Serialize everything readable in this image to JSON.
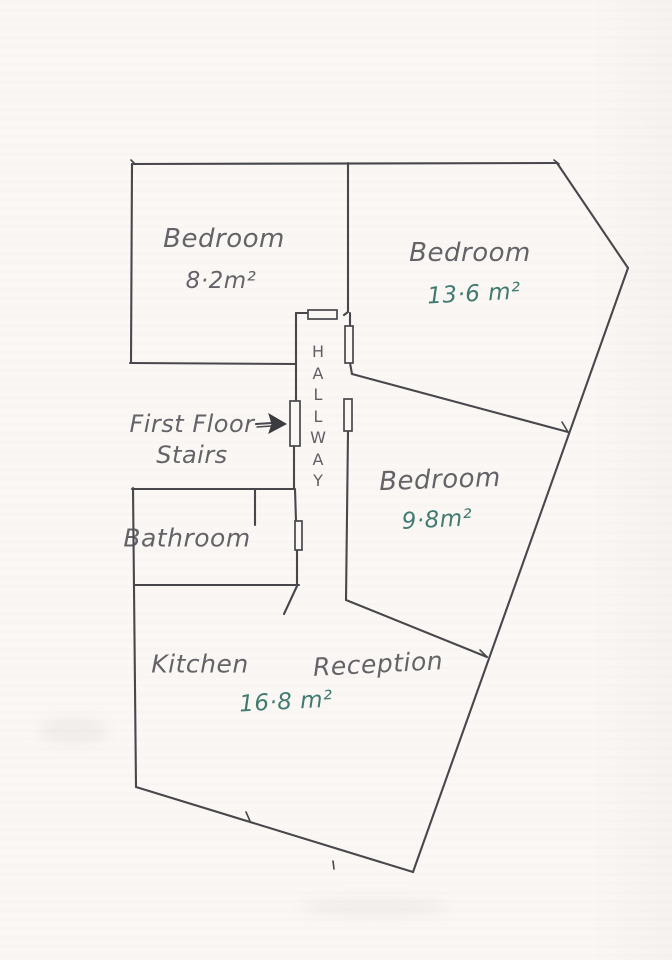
{
  "colors": {
    "paper": "#fbf7f4",
    "ink": "#48484c",
    "pencil_text": "#4f4f55",
    "teal_text": "#2d6e62"
  },
  "rooms": {
    "bedroom_top_left": {
      "name": "Bedroom",
      "area": "8·2m²"
    },
    "bedroom_top_right": {
      "name": "Bedroom",
      "area": "13·6 m²"
    },
    "bedroom_mid_right": {
      "name": "Bedroom",
      "area": "9·8m²"
    },
    "bathroom": {
      "name": "Bathroom"
    },
    "hallway": {
      "name": "HALLWAY"
    },
    "kitchen": {
      "name": "Kitchen"
    },
    "reception": {
      "name": "Reception"
    },
    "kitchen_reception": {
      "area": "16·8 m²"
    }
  },
  "annotations": {
    "first_floor_stairs": {
      "line1": "First Floor",
      "line2": "Stairs"
    }
  }
}
